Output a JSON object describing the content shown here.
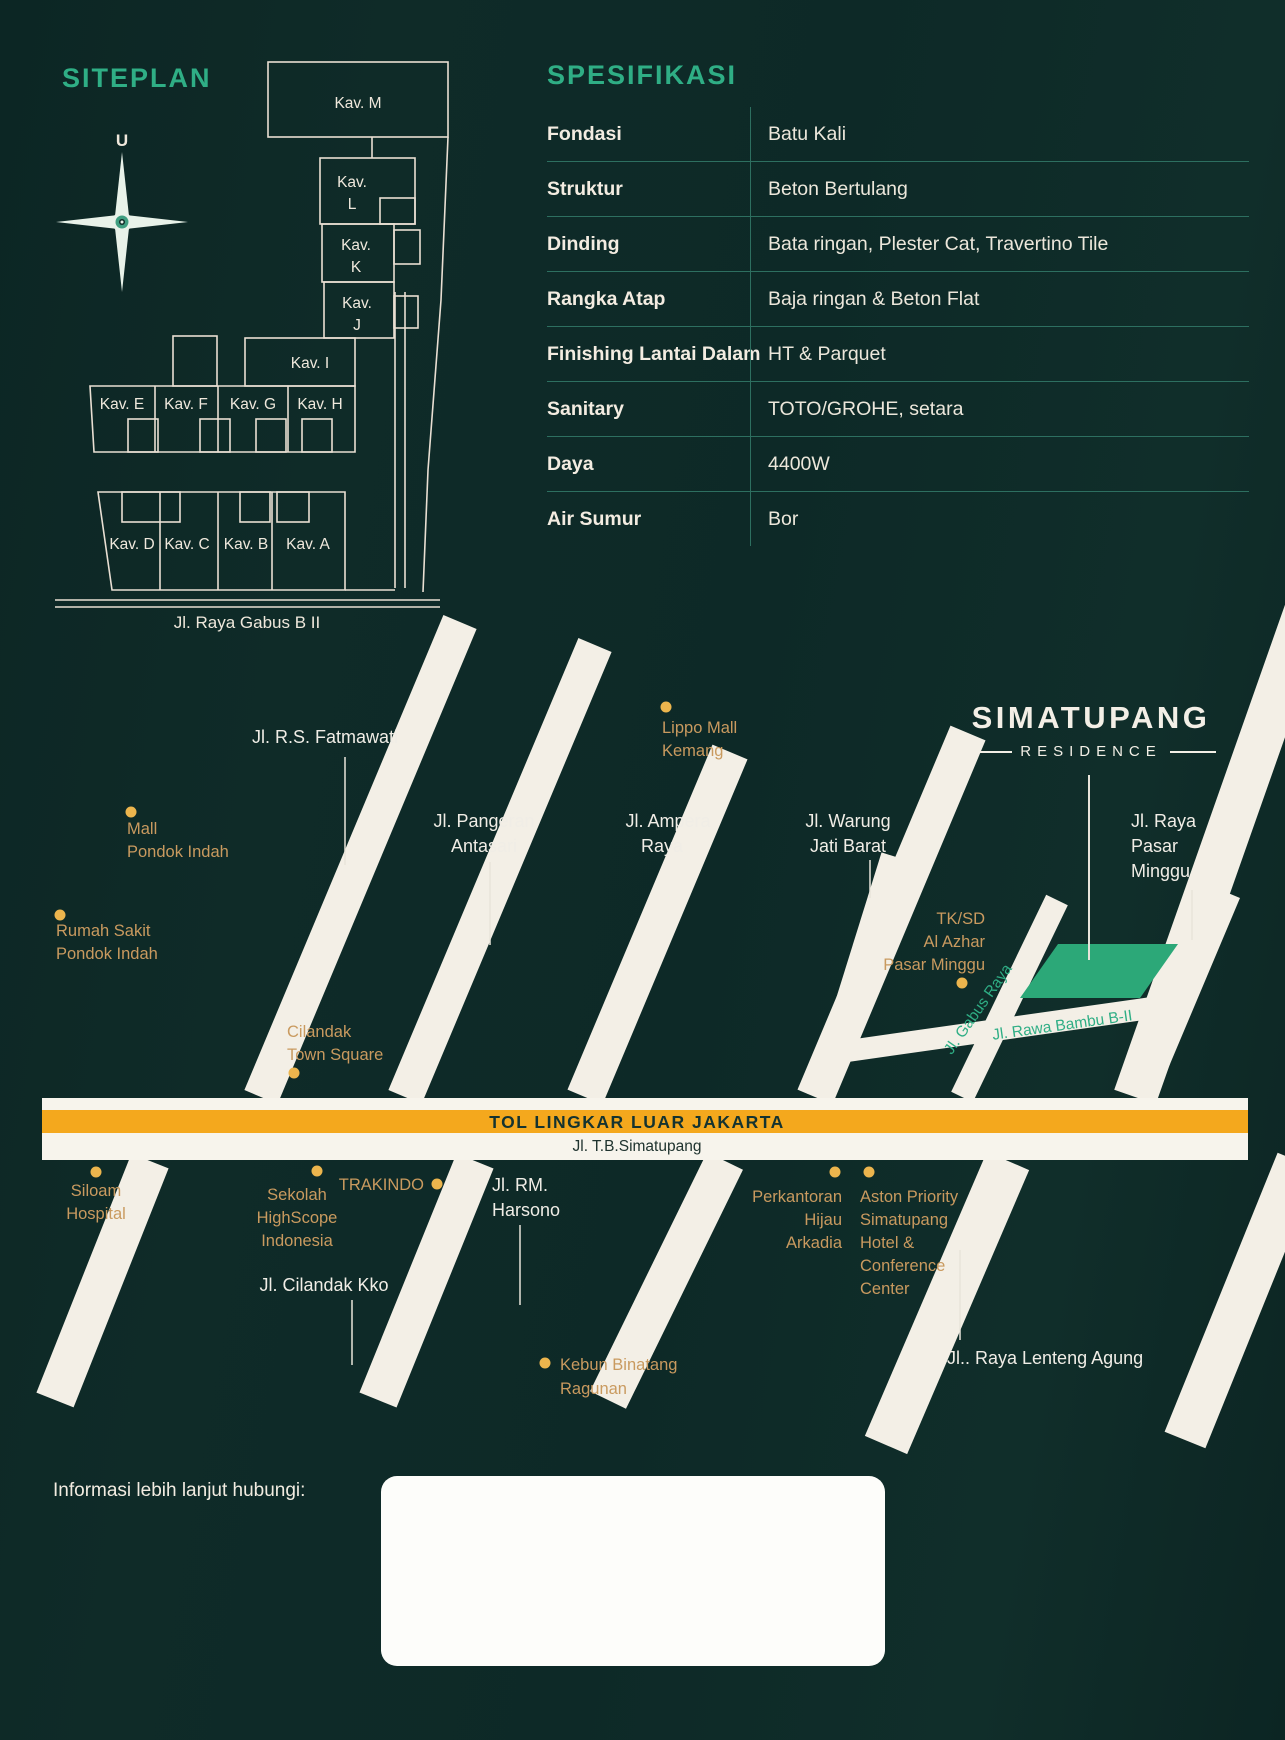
{
  "colors": {
    "background": "#0f2b28",
    "accent_green": "#2fae85",
    "divider_teal": "#2d6f60",
    "poi_gold_text": "#c99a5f",
    "poi_gold_dot": "#ecb54d",
    "toll_orange": "#f4a81d",
    "site_plot_green": "#2ca878",
    "road_white": "#f3efe6"
  },
  "siteplan": {
    "title": "SITEPLAN",
    "compass_north_label": "U",
    "street_label": "Jl. Raya Gabus B II",
    "plots": {
      "m": "Kav. M",
      "l": [
        "Kav.",
        "L"
      ],
      "k": [
        "Kav.",
        "K"
      ],
      "j": [
        "Kav.",
        "J"
      ],
      "i": "Kav. I",
      "e": "Kav. E",
      "f": "Kav. F",
      "g": "Kav. G",
      "h": "Kav. H",
      "d": "Kav. D",
      "c": "Kav. C",
      "b": "Kav. B",
      "a": "Kav. A"
    }
  },
  "spec": {
    "title": "SPESIFIKASI",
    "rows": [
      {
        "label": "Fondasi",
        "value": "Batu Kali"
      },
      {
        "label": "Struktur",
        "value": "Beton Bertulang"
      },
      {
        "label": "Dinding",
        "value": "Bata ringan, Plester Cat, Travertino Tile"
      },
      {
        "label": "Rangka Atap",
        "value": "Baja ringan & Beton Flat"
      },
      {
        "label": "Finishing Lantai Dalam",
        "value": "HT & Parquet"
      },
      {
        "label": "Sanitary",
        "value": "TOTO/GROHE, setara"
      },
      {
        "label": "Daya",
        "value": "4400W"
      },
      {
        "label": "Air Sumur",
        "value": "Bor"
      }
    ]
  },
  "map": {
    "brand": {
      "line1": "SIMATUPANG",
      "line2": "RESIDENCE"
    },
    "toll": {
      "name": "TOL LINGKAR LUAR JAKARTA",
      "road": "Jl. T.B.Simatupang"
    },
    "streets": {
      "fatmawati": "Jl. R.S. Fatmawati",
      "pangeran_antasari": [
        "Jl. Pangeran",
        "Antasari"
      ],
      "ampera": [
        "Jl. Ampera",
        "Raya"
      ],
      "warung_jati": [
        "Jl. Warung",
        "Jati Barat"
      ],
      "raya_pasar_minggu": [
        "Jl. Raya",
        "Pasar",
        "Minggu"
      ],
      "gabus_raya": "Jl. Gabus Raya",
      "rawa_bambu": "Jl. Rawa Bambu B-II",
      "rm_harsono": [
        "Jl. RM.",
        "Harsono"
      ],
      "cilandak_kko": "Jl. Cilandak Kko",
      "lenteng_agung": "Jl.. Raya Lenteng Agung"
    },
    "pois": {
      "lippo": [
        "Lippo Mall",
        "Kemang"
      ],
      "mall_pondok_indah": [
        "Mall",
        "Pondok Indah"
      ],
      "rs_pondok_indah": [
        "Rumah Sakit",
        "Pondok Indah"
      ],
      "cilandak_town_square": [
        "Cilandak",
        "Town Square"
      ],
      "tksd_al_azhar": [
        "TK/SD",
        "Al Azhar",
        "Pasar Minggu"
      ],
      "siloam": [
        "Siloam",
        "Hospital"
      ],
      "highscope": [
        "Sekolah",
        "HighScope",
        "Indonesia"
      ],
      "trakindo": "TRAKINDO",
      "perkantoran_arkadia": [
        "Perkantoran",
        "Hijau",
        "Arkadia"
      ],
      "aston": [
        "Aston Priority",
        "Simatupang",
        "Hotel &",
        "Conference",
        "Center"
      ],
      "kebun_binatang": [
        "Kebun Binatang",
        "Ragunan"
      ]
    }
  },
  "footer": {
    "contact_label": "Informasi lebih lanjut hubungi:"
  }
}
